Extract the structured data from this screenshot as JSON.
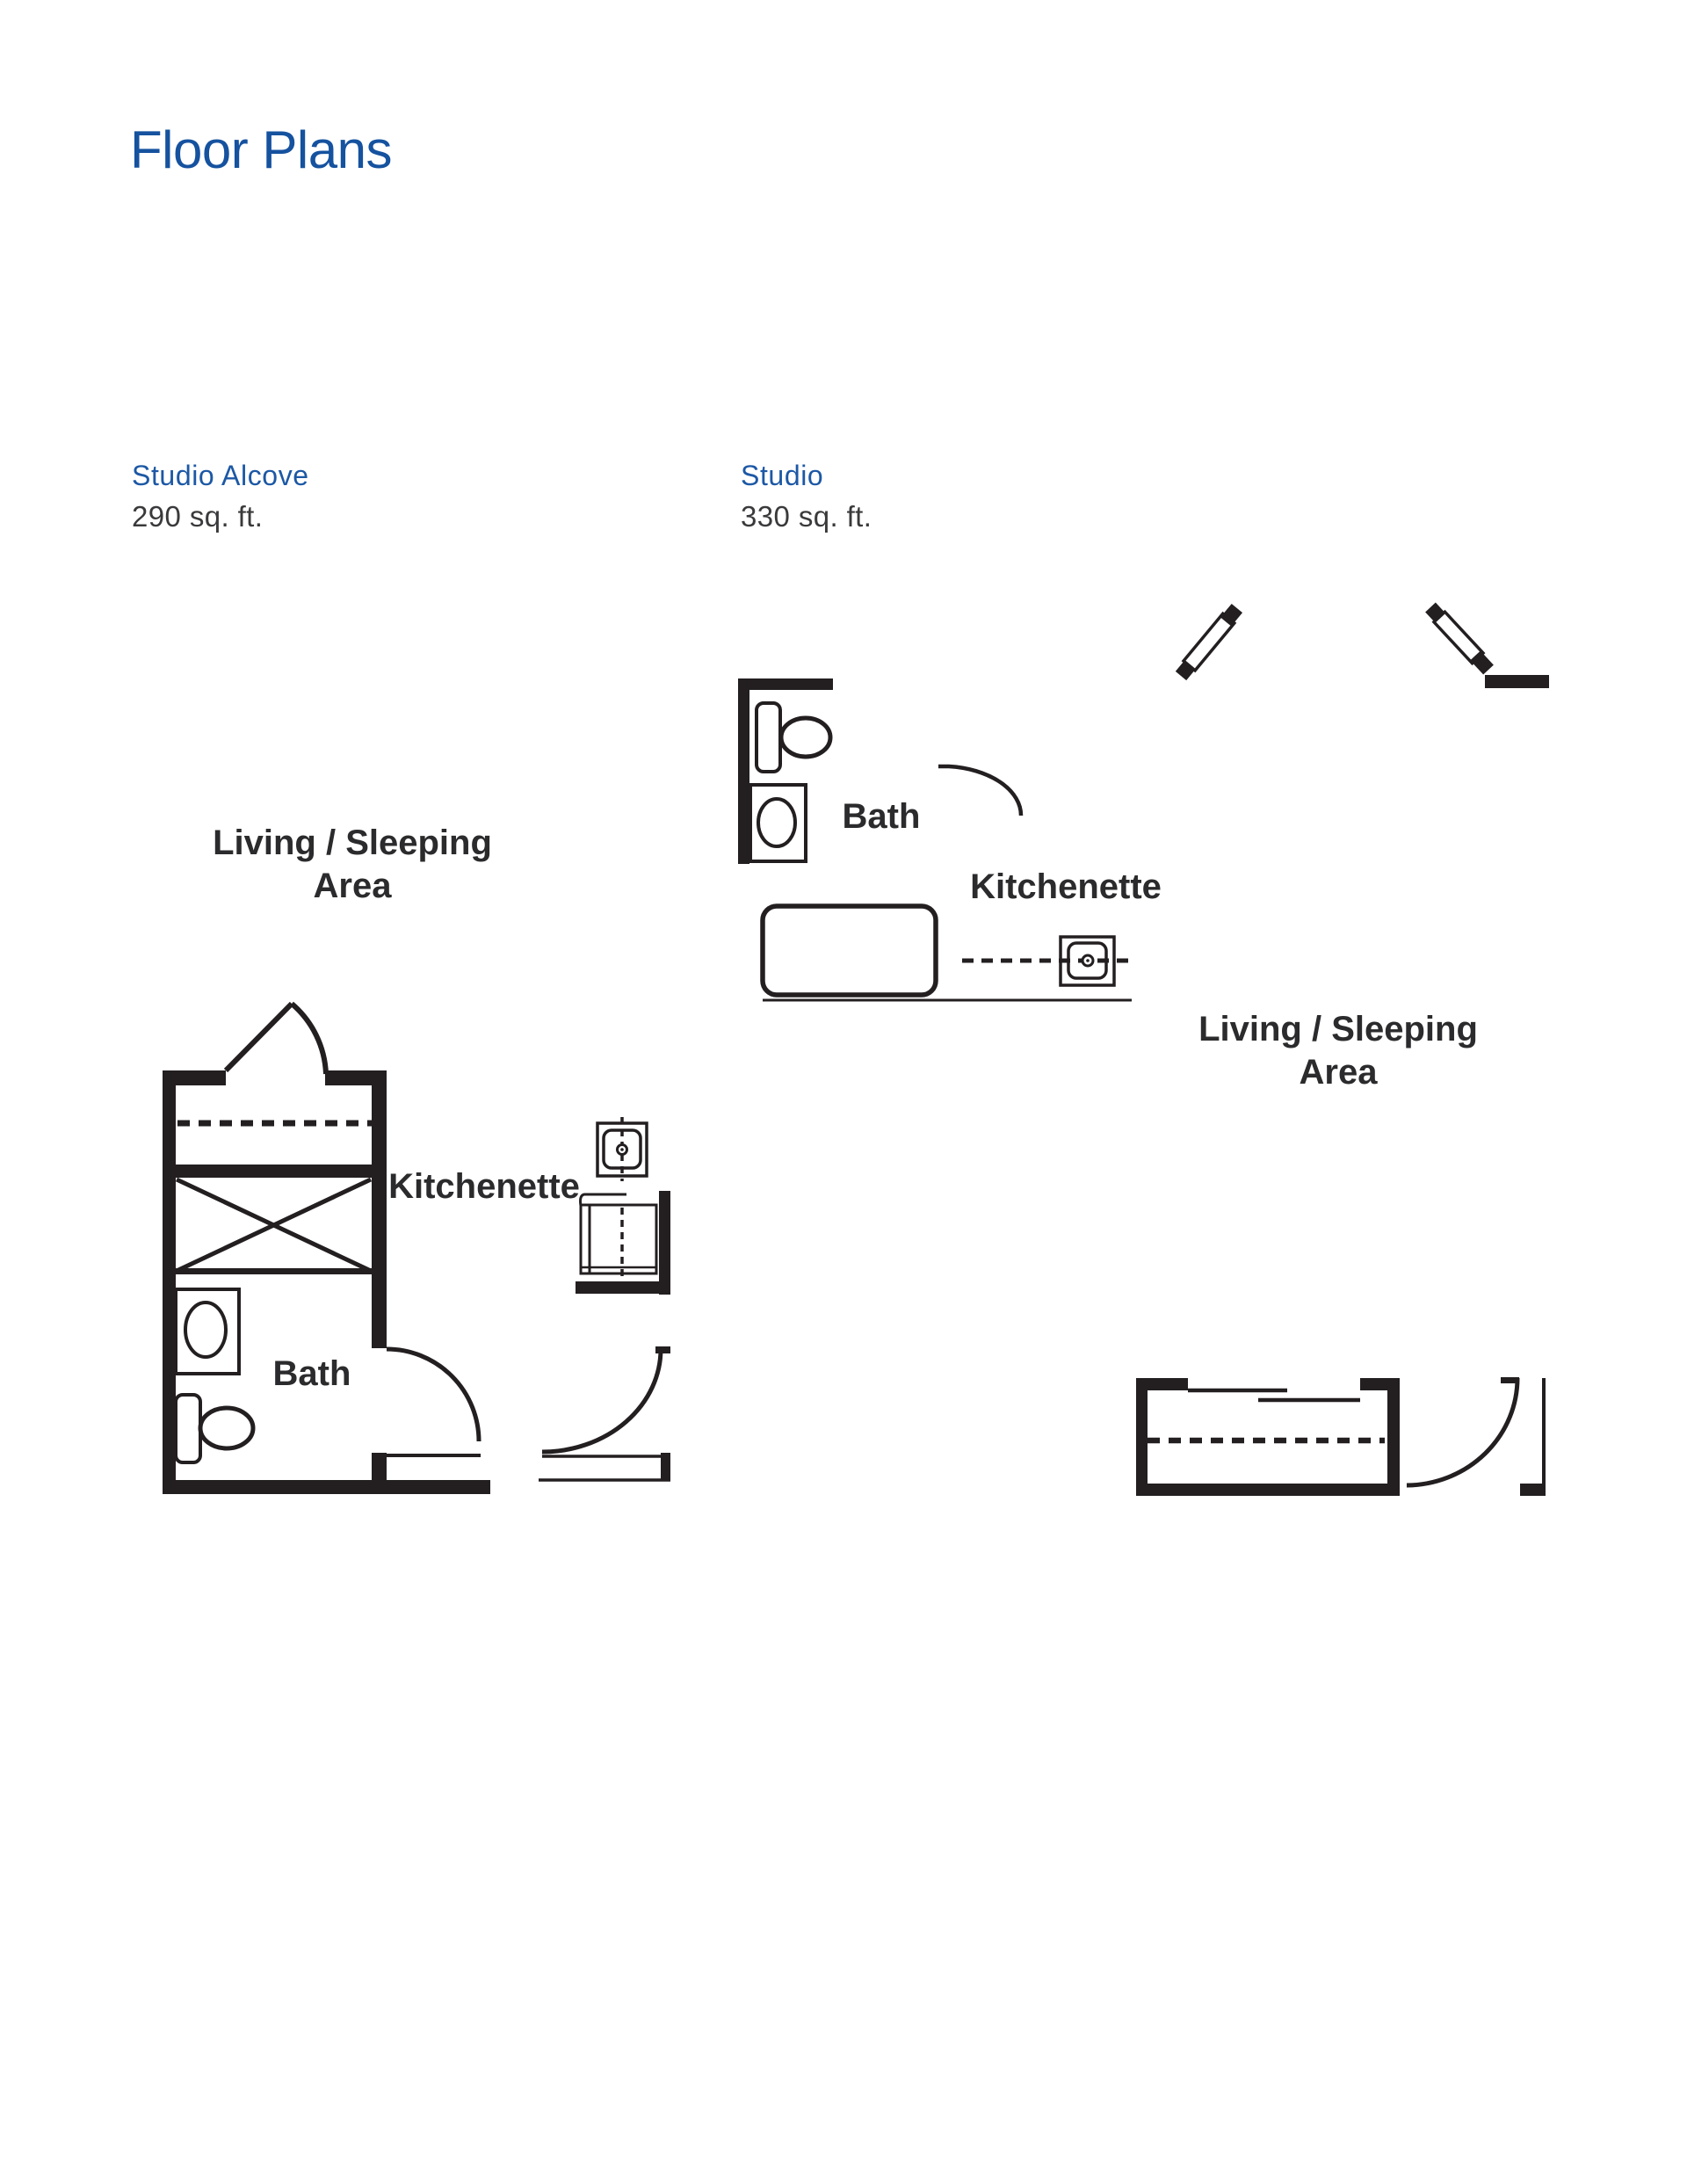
{
  "page": {
    "title": "Floor Plans"
  },
  "colors": {
    "title_blue": "#15529F",
    "header_blue": "#1C58A5",
    "body_text": "#3A3A3C",
    "plan_line": "#231F20",
    "background": "#FFFFFF"
  },
  "plans": [
    {
      "name": "Studio Alcove",
      "area": "290 sq. ft.",
      "labels": {
        "living_line1": "Living / Sleeping",
        "living_line2": "Area",
        "bath": "Bath",
        "kitchenette": "Kitchenette"
      }
    },
    {
      "name": "Studio",
      "area": "330 sq. ft.",
      "labels": {
        "living_line1": "Living / Sleeping",
        "living_line2": "Area",
        "bath": "Bath",
        "kitchenette": "Kitchenette"
      }
    }
  ]
}
